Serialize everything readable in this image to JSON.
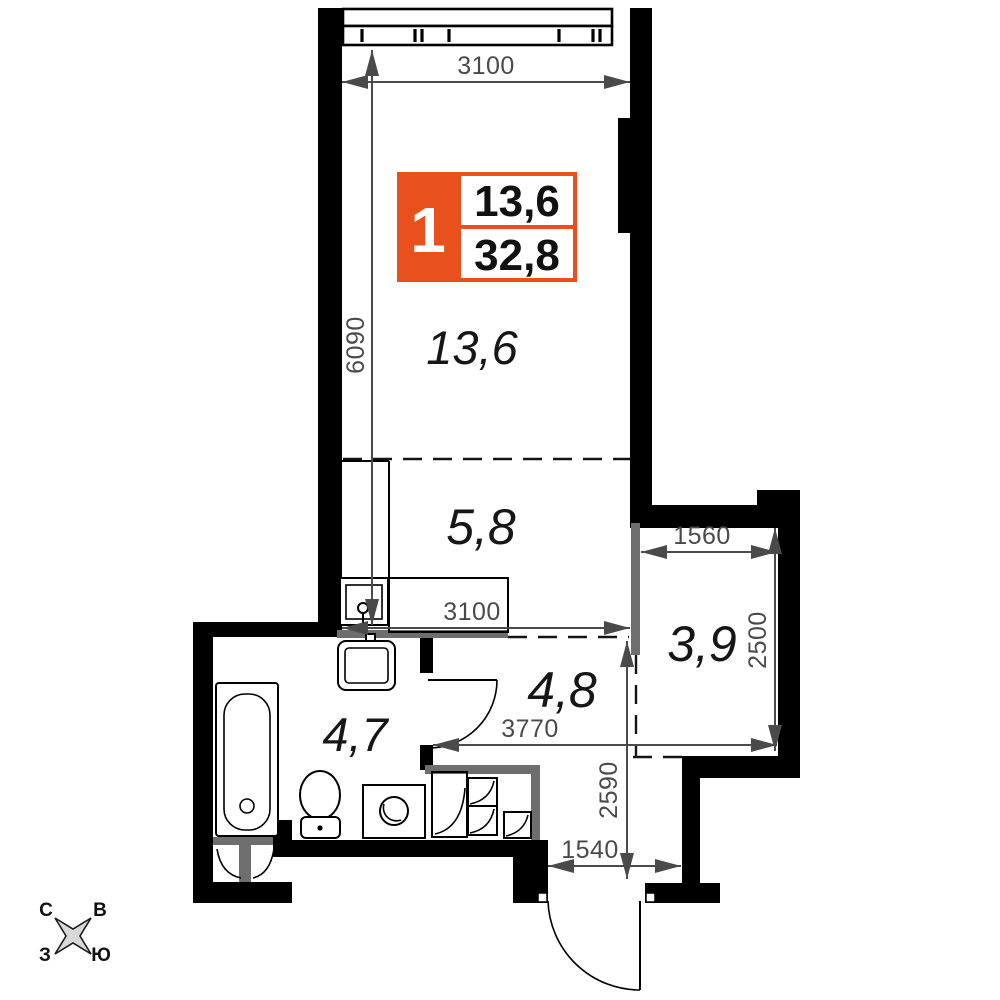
{
  "plan": {
    "badge": {
      "rooms_count": "1",
      "area_living": "13,6",
      "area_total": "32,8"
    },
    "rooms": [
      {
        "name": "living-room",
        "area": "13,6"
      },
      {
        "name": "kitchen",
        "area": "5,8"
      },
      {
        "name": "wardrobe",
        "area": "3,9"
      },
      {
        "name": "bathroom",
        "area": "4,7"
      },
      {
        "name": "hallway",
        "area": "4,8"
      }
    ],
    "dimensions": {
      "top_width": "3100",
      "living_height": "6090",
      "kitchen_width": "3100",
      "wardrobe_width": "1560",
      "wardrobe_height": "2500",
      "hall_width": "3770",
      "hall_height": "2590",
      "entrance_width": "1540"
    },
    "compass": {
      "n": "С",
      "e": "В",
      "w": "З",
      "s": "Ю"
    },
    "colors": {
      "accent": "#E8511E",
      "wall": "#000000",
      "dimension": "#4A4A4A",
      "partition": "#6E6E6E"
    }
  }
}
